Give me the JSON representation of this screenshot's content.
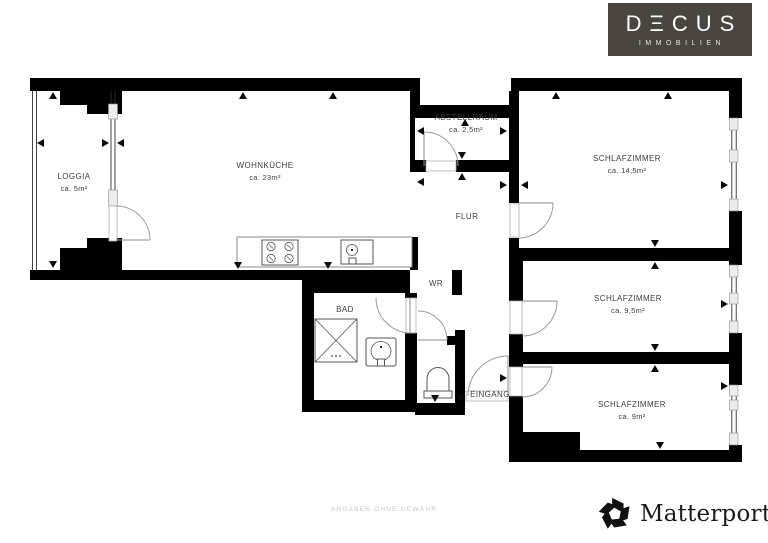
{
  "branding": {
    "decus_name": "DΞCUS",
    "decus_subtitle": "IMMOBILIEN",
    "matterport": "Matterport",
    "matterport_mark": "®"
  },
  "footer": {
    "disclaimer": "ANGABEN OHNE GEWÄHR"
  },
  "rooms": {
    "loggia": {
      "name": "LOGGIA",
      "area": "ca. 5m²"
    },
    "wohnkueche": {
      "name": "WOHNKÜCHE",
      "area": "ca. 23m²"
    },
    "abstellraum": {
      "name": "ABSTELLRAUM",
      "area": "ca. 2,5m²"
    },
    "schlafzimmer_1": {
      "name": "SCHLAFZIMMER",
      "area": "ca. 14,5m²"
    },
    "flur": {
      "name": "FLUR"
    },
    "wr": {
      "name": "WR"
    },
    "bad": {
      "name": "BAD"
    },
    "schlafzimmer_2": {
      "name": "SCHLAFZIMMER",
      "area": "ca. 9,5m²"
    },
    "eingang": {
      "name": "EINGANG"
    },
    "schlafzimmer_3": {
      "name": "SCHLAFZIMMER",
      "area": "ca. 9m²"
    }
  },
  "icons": {
    "matterport_logo": "pinwheel-m-logo",
    "decus_logo": "dark-box-wordmark"
  },
  "colors": {
    "wall": "#000000",
    "background": "#ffffff",
    "decus_bg": "#4a453f",
    "decus_text": "#ffffff",
    "matterport_text": "#1b1b1b",
    "disclaimer_text": "#c6c6c6",
    "door_arc": "#9a9a9a",
    "fixture_line": "#555555",
    "label_text": "#3c3c3c"
  }
}
